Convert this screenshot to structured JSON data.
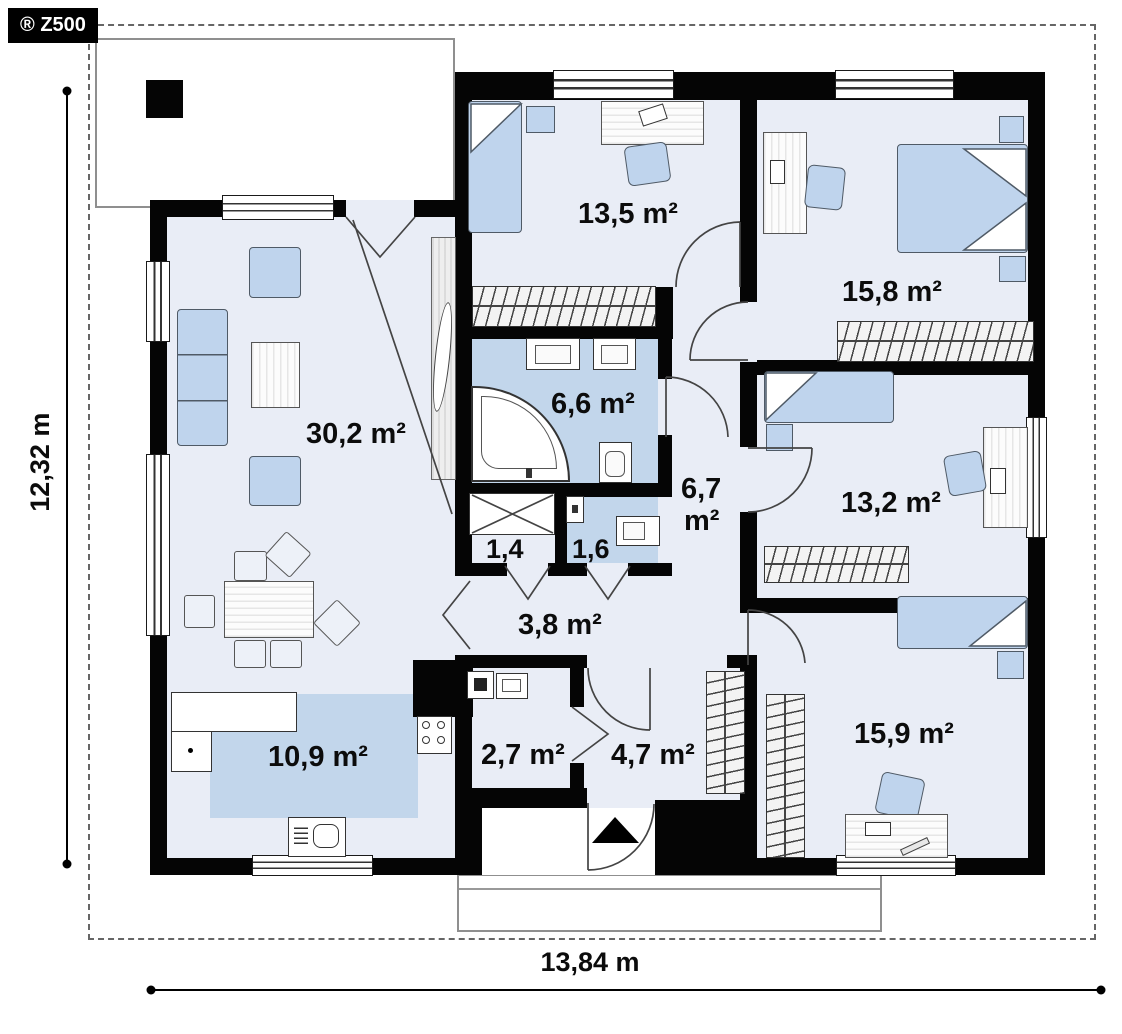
{
  "branding": {
    "logo_text": "® Z500"
  },
  "plan": {
    "total_width_label": "13,84 m",
    "total_height_label": "12,32 m",
    "rooms": {
      "living": {
        "area": "30,2 m²"
      },
      "kitchen": {
        "area": "10,9 m²"
      },
      "bedroom_top": {
        "area": "13,5 m²"
      },
      "bathroom": {
        "area": "6,6 m²"
      },
      "hall": {
        "area_value": "6,7",
        "area_unit": "m²"
      },
      "storage": {
        "area": "1,4"
      },
      "wc": {
        "area": "1,6"
      },
      "corridor": {
        "area": "3,8 m²"
      },
      "bedroom_right_top": {
        "area": "15,8 m²"
      },
      "bedroom_right_mid": {
        "area": "13,2 m²"
      },
      "bedroom_right_bottom": {
        "area": "15,9 m²"
      },
      "utility": {
        "area": "2,7 m²"
      },
      "entry_hall": {
        "area": "4,7 m²"
      }
    },
    "colors": {
      "wall": "#050505",
      "room_floor": "#e9edf6",
      "wet_floor": "#c2d6eb",
      "furniture": "#bfd4ed",
      "badge_bg": "#000000",
      "badge_text": "#ffffff"
    }
  }
}
